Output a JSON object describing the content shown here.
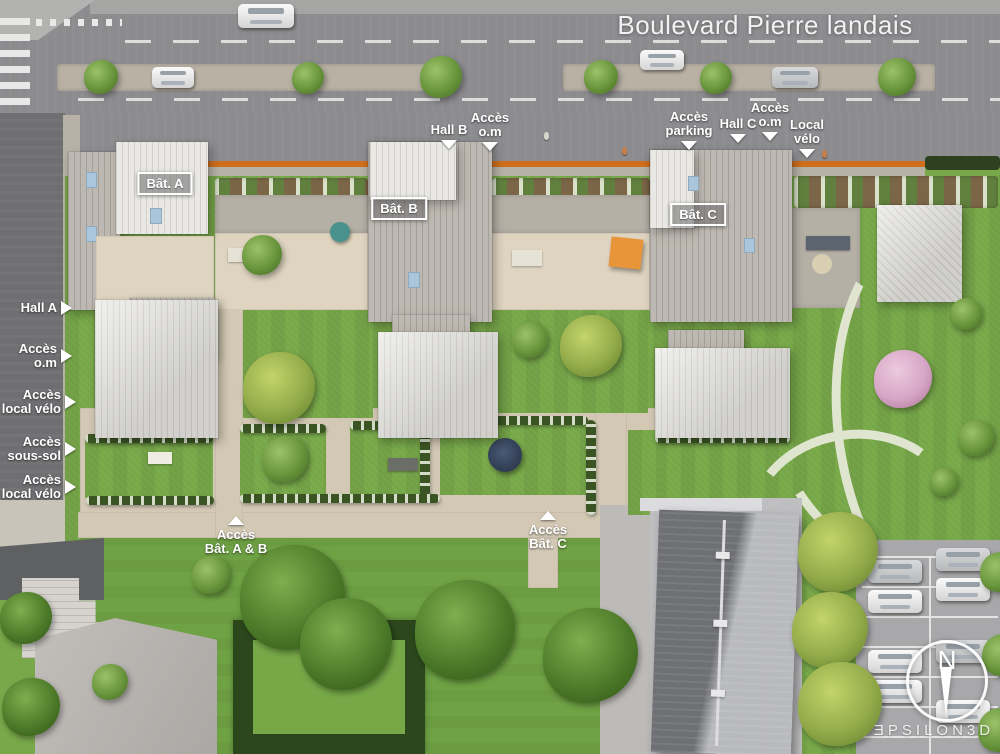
{
  "street": {
    "name": "Boulevard Pierre landais"
  },
  "buildings": [
    {
      "label": "Bât. A"
    },
    {
      "label": "Bât. B"
    },
    {
      "label": "Bât. C"
    }
  ],
  "top_labels": [
    {
      "line1": "Hall B"
    },
    {
      "line1": "Accès",
      "line2": "o.m"
    },
    {
      "line1": "Accès",
      "line2": "parking"
    },
    {
      "line1": "Hall C"
    },
    {
      "line1": "Accès",
      "line2": "o.m"
    },
    {
      "line1": "Local",
      "line2": "vélo"
    }
  ],
  "left_labels": [
    {
      "line1": "Hall A"
    },
    {
      "line1": "Accès",
      "line2": "o.m"
    },
    {
      "line1": "Accès",
      "line2": "local vélo"
    },
    {
      "line1": "Accès",
      "line2": "sous-sol"
    },
    {
      "line1": "Accès",
      "line2": "local vélo"
    }
  ],
  "bottom_labels": [
    {
      "line1": "Accès",
      "line2": "Bât. A & B"
    },
    {
      "line1": "Accès",
      "line2": "Bât. C"
    }
  ],
  "compass": {
    "north": "N"
  },
  "watermark": {
    "brand": "ƎPSILON3D"
  },
  "colors": {
    "site_boundary_orange": "#cf6f1d",
    "parasol_orange": "#e8953a"
  }
}
